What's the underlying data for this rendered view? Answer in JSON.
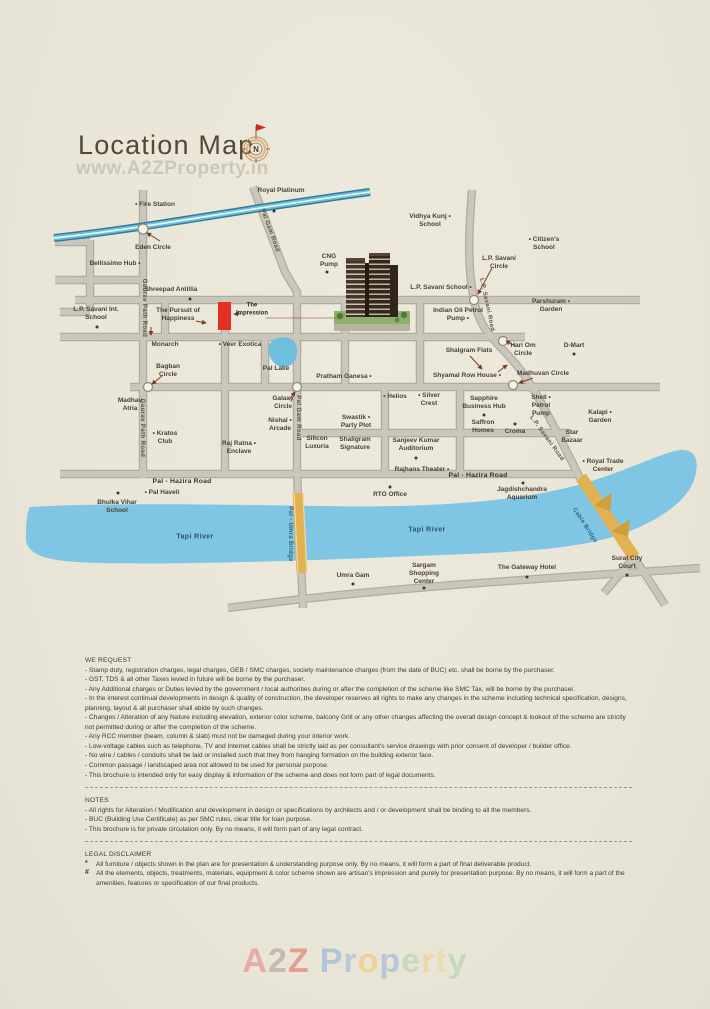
{
  "page": {
    "title": "Location Map",
    "watermark_top": "www.A2ZProperty.in",
    "compass_letter": "N"
  },
  "colors": {
    "background": "#e9e5d7",
    "accent_red": "#e33127",
    "river_blue": "#7fc6e4",
    "road_gray": "#cac6bb",
    "bridge_tan": "#e2b152",
    "canal_teal": "#2f7d98",
    "label_brown": "#4a4135"
  },
  "map": {
    "labels": {
      "fire_station": "• Fire Station",
      "royal_platinum": "Royal Platinum",
      "eden_circle": "Eden Circle",
      "bellissimo_hub": "Bellissimo Hub •",
      "vidhya_kunj_school": "Vidhya Kunj • School",
      "citizens_school": "• Citizen's School",
      "cng_pump": "CNG Pump",
      "lp_savani_circle": "L.P. Savani Circle",
      "shreepad_antillia": "Shreepad Antillia",
      "lp_savani_school": "L.P. Savani School •",
      "lp_savani_int_school": "L.P. Savani Int. School",
      "pursuit_of_happiness": "The Pursuit of Happiness",
      "the_impression": "The Impression",
      "indian_oil_petrol_pump": "Indian Oil Petrol Pump •",
      "parshuram_garden": "Parshuram • Garden",
      "monarch": "Monarch",
      "veer_exotica": "• Veer Exotica",
      "shalgram_flats": "Shalgram Flats",
      "hari_om_circle": "Hari Om Circle",
      "d_mart": "D-Mart",
      "bagban_circle": "Bagban Circle",
      "pal_lake": "Pal Lake",
      "pratham_ganesa": "Pratham Ganesa •",
      "shyamal_row_house": "Shyamal Row House •",
      "madhuvan_circle": "Madhuvan Circle",
      "madhav_atria": "Madhav Atria",
      "galaxy_circle": "Galaxy Circle",
      "helios": "• Helios",
      "silver_crest": "• Silver Crest",
      "sapphire_business_hub": "Sapphire Business Hub",
      "shell_petrol_pump": "Shell • Petrol Pump",
      "kalapi_garden": "Kalapi • Garden",
      "kratos_club": "• Kratos Club",
      "nishal_arcade": "Nishal • Arcade",
      "swastik_party_plot": "Swastik • Party Plot",
      "saffron_homes": "Saffron Homes",
      "croma": "Croma",
      "star_bazaar": "Star Bazaar",
      "raj_ratna_enclave": "Raj Ratna • Enclave",
      "silicon_luxuria": "Silicon Luxuria",
      "shaligram_signature": "Shaligram Signature",
      "sanjeev_kumar_auditorium": "Sanjeev Kumar Auditorium",
      "royal_trade_center": "• Royal Trade Center",
      "rajhans_theater": "Rajhans Theater •",
      "pal_hazira_road": "Pal - Hazira Road",
      "rto_office": "RTO Office",
      "pal_haveli": "• Pal Haveli",
      "bhulka_vihar_school": "Bhulka Vihar School",
      "jagdishchandra_aquarium": "Jagdishchandra Aquarium",
      "tapi_river": "Tapi River",
      "umra_gam": "Umra Gam",
      "sargam_shopping_center": "Sargam Shopping Center",
      "gateway_hotel": "The Gateway Hotel",
      "surat_city_court": "Surat City Court",
      "gaurav_path_road": "Gaurav Path Road",
      "pal_gam_road": "Pal Gam Road",
      "lp_savani_road": "L.P. Savani Road",
      "pal_umra_bridge": "Pal - Umra Bridge",
      "cable_bridge": "Cable Bridge"
    }
  },
  "sections": {
    "we_request": {
      "heading": "WE REQUEST",
      "items": [
        "- Stamp duty, registration charges, legal charges, GEB / SMC charges, society maintenance charges (from the date of BUC) etc. shall be borne by the purchaser.",
        "- GST, TDS & all other Taxes levied in future will be borne by the purchaser.",
        "- Any Additional charges or Duties levied by the government / local authorities during or after the completion of the scheme like SMC Tax, will be borne by the purchaser.",
        "- In the interest continual developments in design & quality of construction, the developer reserves all rights to make any changes in the scheme including technical specification, designs, planning, layout & all purchaser shall abide by such changes.",
        "- Changes / Alteration of any Nature including elevation, exterior color scheme, balcony Grill or any other changes affecting the overall design concept & lookout of the scheme are strictly not permitted during or after the completion of the scheme.",
        "- Any RCC member (beam, column & slab) must not be damaged during your interior work.",
        "- Low-voltage cables such as telephone, TV and Internet cables shall be strictly laid as per consultant's service drawings with prior consent of developer / builder office.",
        "- No wire / cables / conduits shall be laid or installed such that they from hanging formation on the building exterior face.",
        "- Common passage / landscaped area not allowed to be used for personal purpose.",
        "- This brochure is intended only for easy display & information of the scheme and does not form part of legal documents."
      ]
    },
    "notes": {
      "heading": "NOTES",
      "items": [
        "- All rights for Alteration / Modification and development in design or specifications by architects and / or development shall be binding to all the members.",
        "- BUC (Building Use Certificate) as per SMC rules, clear title for loan purpose.",
        "- This brochure is for private circulation only. By no means, it will form part of any legal contract."
      ]
    },
    "legal": {
      "heading": "LEGAL DISCLAIMER",
      "items": [
        {
          "marker": "*",
          "text": "All furniture / objects shown in the plan are for presentation & understanding purpose only. By no means, it will form a part of final deliverable product."
        },
        {
          "marker": "#",
          "text": "All the elements, objects, treatments, materials, equipment & color scheme shown are artisan's impression and purely for presentation purpose. By no means, it will form a part of the amenities, features or specification of our final products."
        }
      ]
    }
  },
  "footer_watermark": {
    "text": "A2Z Property",
    "letters": [
      {
        "ch": "A",
        "color": "#e57373"
      },
      {
        "ch": "2",
        "color": "#a09488"
      },
      {
        "ch": "Z",
        "color": "#e05a50"
      },
      {
        "ch": "P",
        "color": "#7aa7dc"
      },
      {
        "ch": "r",
        "color": "#8fb0d8"
      },
      {
        "ch": "o",
        "color": "#f2c05a"
      },
      {
        "ch": "p",
        "color": "#85abde"
      },
      {
        "ch": "e",
        "color": "#a5cfa5"
      },
      {
        "ch": "r",
        "color": "#e8cf7a"
      },
      {
        "ch": "t",
        "color": "#e8d98a"
      },
      {
        "ch": "y",
        "color": "#a5cfa5"
      }
    ]
  }
}
